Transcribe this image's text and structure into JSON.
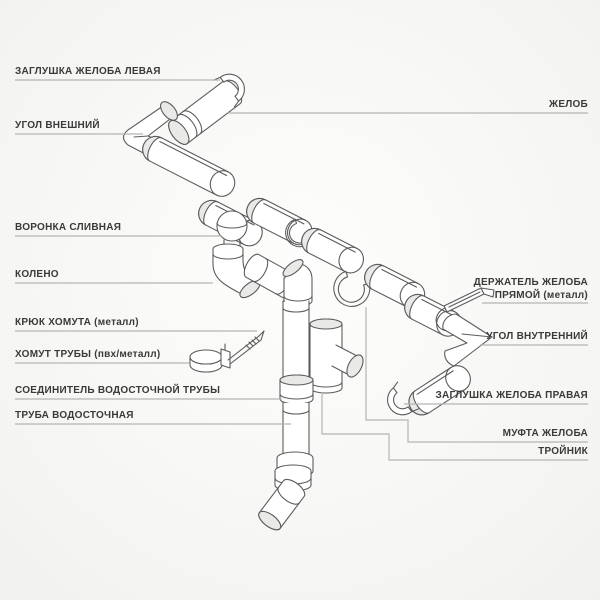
{
  "diagram": {
    "subject": "Водосточная система — схема элементов"
  },
  "labels": {
    "left": [
      {
        "text": "ЗАГЛУШКА ЖЕЛОБА ЛЕВАЯ"
      },
      {
        "text": "УГОЛ ВНЕШНИЙ"
      },
      {
        "text": "ВОРОНКА СЛИВНАЯ"
      },
      {
        "text": "КОЛЕНО"
      },
      {
        "text": "КРЮК ХОМУТА (металл)"
      },
      {
        "text": "ХОМУТ ТРУБЫ (пвх/металл)"
      },
      {
        "text": "СОЕДИНИТЕЛЬ ВОДОСТОЧНОЙ ТРУБЫ"
      },
      {
        "text": "ТРУБА ВОДОСТОЧНАЯ"
      }
    ],
    "right": [
      {
        "text": "ЖЕЛОБ"
      },
      {
        "text": "ДЕРЖАТЕЛЬ ЖЕЛОБА",
        "text2": "ПРЯМОЙ (металл)"
      },
      {
        "text": "УГОЛ ВНУТРЕННИЙ"
      },
      {
        "text": "ЗАГЛУШКА ЖЕЛОБА ПРАВАЯ"
      },
      {
        "text": "МУФТА ЖЕЛОБА"
      },
      {
        "text": "ТРОЙНИК"
      }
    ]
  },
  "colors": {
    "label_text": "#3a3a3a",
    "connector_line": "#b5b5b3",
    "drawing_line": "#5c5c5c",
    "background": "#f7f7f5"
  }
}
